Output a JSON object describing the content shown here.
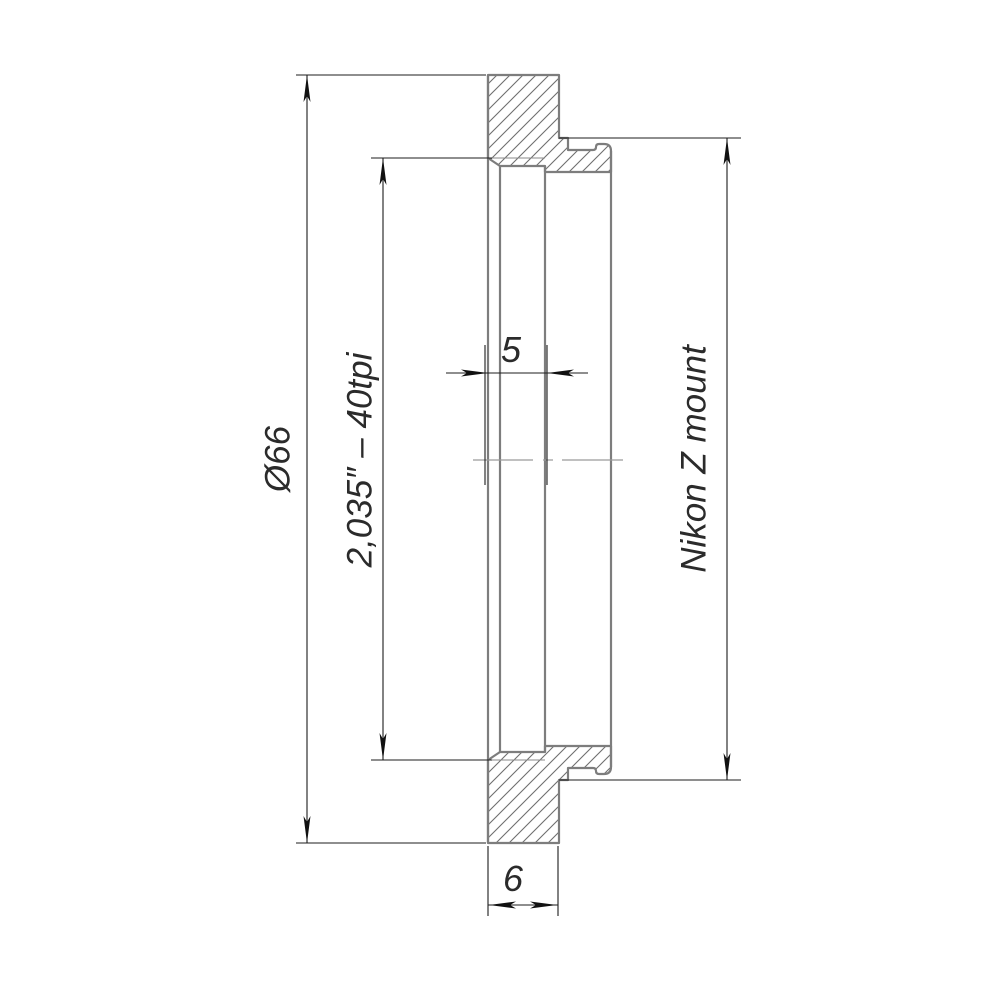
{
  "drawing": {
    "type": "engineering-cross-section",
    "labels": {
      "outer_diameter": "Ø66",
      "thread_spec": "2,035″ – 40tpi",
      "thread_length": "5",
      "flange_thickness": "6",
      "mount": "Nikon Z mount"
    },
    "colors": {
      "object_line": "#7d7d7d",
      "hatch_line": "#6f6f6f",
      "dimension_line": "#1d1d1d",
      "centerline": "#9a9a9a",
      "background": "#ffffff"
    }
  }
}
